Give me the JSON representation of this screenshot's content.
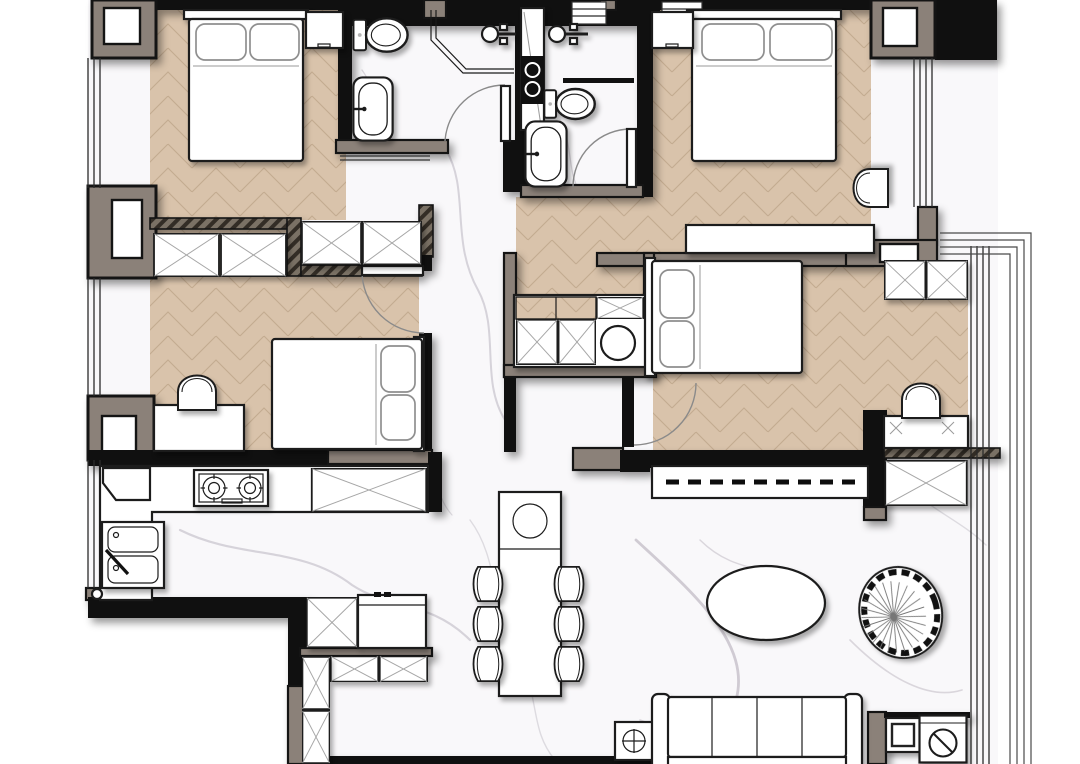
{
  "title": "apartment-floor-plan",
  "palette": {
    "wall": "#101010",
    "pillar": "#8b8179",
    "wood": "#d9c3ab",
    "woodline": "#c3ab90",
    "marble": "#f9f8fa",
    "vein": "#b4aeb9",
    "veindark": "#938d98",
    "hatch": "#7a7165",
    "hatchline": "#332d26",
    "line": "#1c1c1c"
  },
  "rooms": [
    {
      "id": "bedroom-top-left",
      "floor": "wood",
      "furniture": [
        "double-bed",
        "pillow x2",
        "nightstand",
        "wardrobe"
      ]
    },
    {
      "id": "bathroom-left",
      "floor": "marble",
      "furniture": [
        "toilet",
        "bathtub",
        "shower-enclosure",
        "shower-head",
        "door"
      ]
    },
    {
      "id": "bathroom-right",
      "floor": "marble",
      "furniture": [
        "vanity-column",
        "toilet",
        "bathtub",
        "shower-head",
        "glass-screen",
        "door"
      ]
    },
    {
      "id": "bedroom-top-right",
      "floor": "wood",
      "furniture": [
        "double-bed",
        "pillow x2",
        "nightstand",
        "armchair",
        "desk"
      ]
    },
    {
      "id": "bedroom-middle-left",
      "floor": "wood",
      "furniture": [
        "wardrobe",
        "hall-closet",
        "single-bed",
        "pillow x2",
        "desk",
        "desk-chair",
        "door"
      ]
    },
    {
      "id": "bedroom-middle-right",
      "floor": "wood",
      "furniture": [
        "closet",
        "laundry-basket",
        "single-bed",
        "pillow x2",
        "bay-wardrobe",
        "desk",
        "desk-chair",
        "storage-cabinet",
        "door"
      ]
    },
    {
      "id": "kitchen",
      "floor": "marble",
      "furniture": [
        "l-counter",
        "gas-hob",
        "double-sink",
        "corner-cabinet",
        "tall-cabinet"
      ]
    },
    {
      "id": "entry",
      "floor": "marble",
      "furniture": [
        "shoe-cabinet",
        "refrigerator",
        "bench-cabinet",
        "tall-cabinet"
      ]
    },
    {
      "id": "dining-area",
      "floor": "marble",
      "furniture": [
        "dining-table",
        "dining-chair x6",
        "table-bowl",
        "side-table"
      ]
    },
    {
      "id": "living-area",
      "floor": "marble",
      "furniture": [
        "tv-console",
        "sliding-track",
        "sofa",
        "coffee-table",
        "rattan-chair",
        "side-table",
        "cabinet",
        "washing-machine"
      ]
    },
    {
      "id": "balcony",
      "floor": "none",
      "furniture": [
        "window-frames"
      ]
    }
  ]
}
